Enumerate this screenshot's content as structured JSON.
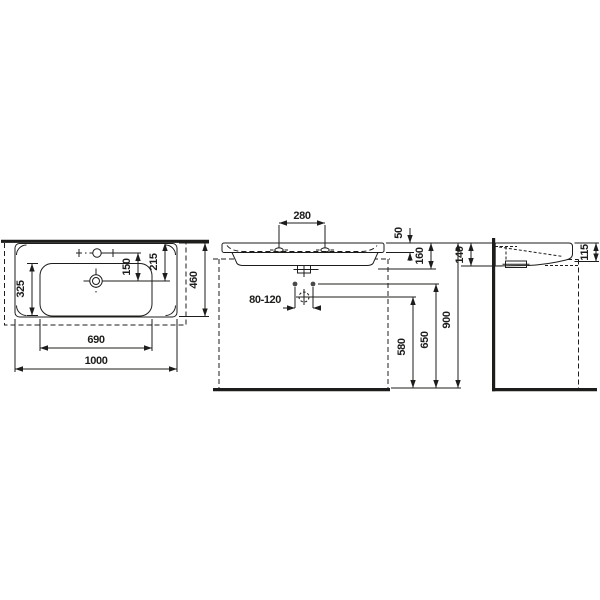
{
  "meta": {
    "type": "technical-dimension-drawing",
    "subject": "wall-hung washbasin, three orthographic views",
    "units": "mm"
  },
  "colors": {
    "line": "#1d1d1b",
    "background": "#ffffff",
    "fixing_dot": "#4a4a4a"
  },
  "views": {
    "plan": {
      "dims": {
        "overall_width": "1000",
        "bowl_width": "690",
        "bowl_depth": "325",
        "tap_to_drain": "150",
        "rear_to_drain": "215",
        "overall_depth": "460"
      }
    },
    "front": {
      "dims": {
        "tap_hole_spacing": "280",
        "rim_thickness": "50",
        "basin_height": "160",
        "fixing_hole_spacing": "80-120",
        "drain_height": "580",
        "fixing_height": "650",
        "rim_top_height": "900"
      }
    },
    "side": {
      "dims": {
        "rear_depth": "140",
        "front_edge_depth": "115"
      }
    }
  }
}
